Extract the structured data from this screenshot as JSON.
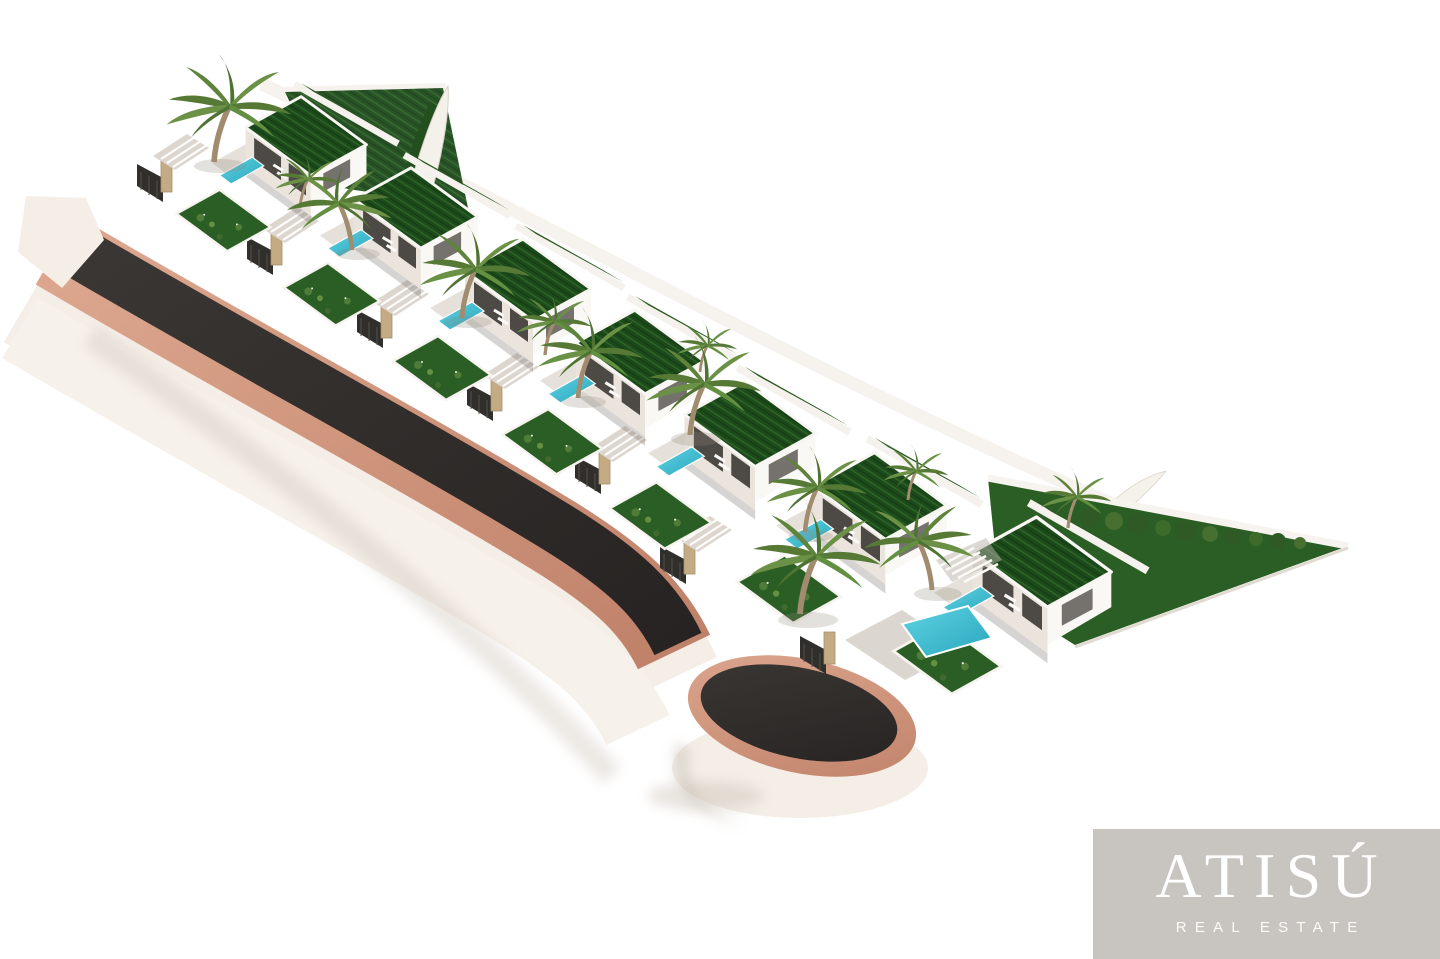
{
  "scene": {
    "description": "Aerial 3D architectural rendering of a hillside development of seven modern white villas with green grass roofs, private turquoise pools and palm trees, arranged in a stepped row along a dark asphalt road with terracotta curbs that ends in a circular cul-de-sac; white background",
    "villa_count": 7,
    "background_color": "#ffffff"
  },
  "palette": {
    "asphalt-dark": "#262322",
    "asphalt-light": "#3b3734",
    "curb": "#c08169",
    "curb-light": "#dda78f",
    "embankment": "#f4eee7",
    "embankment-shadow": "#ddd4c9",
    "wall-bright": "#faf8f5",
    "wall-shaded": "#eae4dc",
    "roof-grass": "#1d4a1b",
    "roof-grass-light": "#2e6527",
    "roof-grass-dark": "#133a12",
    "lawn": "#2a5e25",
    "pool": "#5fd3e2",
    "pool-deep": "#2aa6be",
    "palm-frond": "#567a36",
    "palm-frond-2": "#6b9146",
    "palm-trunk": "#a28c6f",
    "stone": "#c4ab83",
    "gate": "#312f2c",
    "shadow": "#c9c0b4",
    "logo-bg": "#c8c4c0",
    "logo-text": "#ffffff"
  },
  "logo": {
    "brand": "ATISÚ",
    "tagline": "REAL ESTATE"
  }
}
